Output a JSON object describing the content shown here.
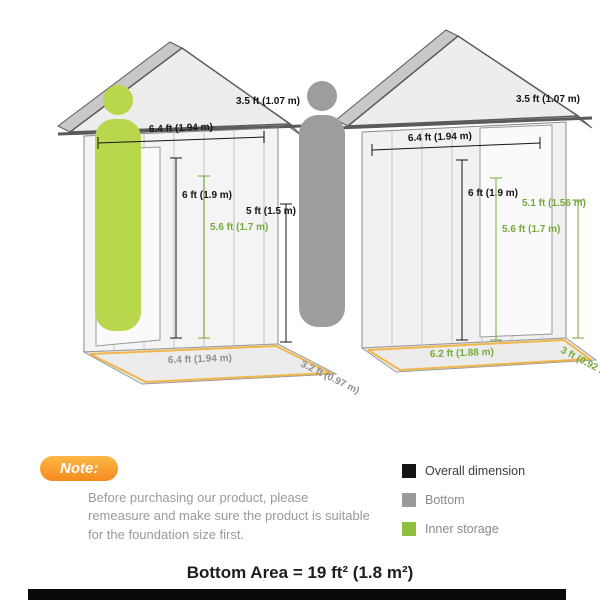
{
  "diagram": {
    "left_view": {
      "labels": {
        "overall_width": "6.4 ft (1.94 m)",
        "overall_depth": "3.5 ft (1.07 m)",
        "peak_height": "6 ft (1.9 m)",
        "inner_height": "5.6 ft (1.7 m)",
        "eave_height": "5 ft (1.5 m)",
        "bottom_width": "6.4 ft (1.94 m)",
        "bottom_depth": "3.2 ft (0.97 m)"
      }
    },
    "right_view": {
      "labels": {
        "overall_width": "6.4 ft (1.94 m)",
        "overall_depth": "3.5 ft (1.07 m)",
        "peak_height": "6 ft (1.9 m)",
        "inner_height": "5.6 ft (1.7 m)",
        "inner_side_height": "5.1 ft (1.56 m)",
        "inner_width": "6.2 ft (1.88 m)",
        "inner_depth": "3 ft (0.92 m)"
      }
    },
    "colors": {
      "overall": "#141414",
      "bottom": "#8f8f8f",
      "inner_storage": "#76a93c",
      "floor_highlight": "#f0b64a",
      "person_left": "#b9d74d",
      "person_right": "#9d9d9d"
    }
  },
  "legend": {
    "items": [
      {
        "label": "Overall dimension",
        "color": "#141414"
      },
      {
        "label": "Bottom",
        "color": "#9a9a9a"
      },
      {
        "label": "Inner storage",
        "color": "#8fbf3f"
      }
    ]
  },
  "note": {
    "badge": "Note:",
    "badge_color": "#f68b1f",
    "text": "Before purchasing our product, please remeasure and make sure the product is suitable for the foundation size first."
  },
  "footer": {
    "bottom_area": "Bottom Area = 19 ft² (1.8 m²)"
  }
}
